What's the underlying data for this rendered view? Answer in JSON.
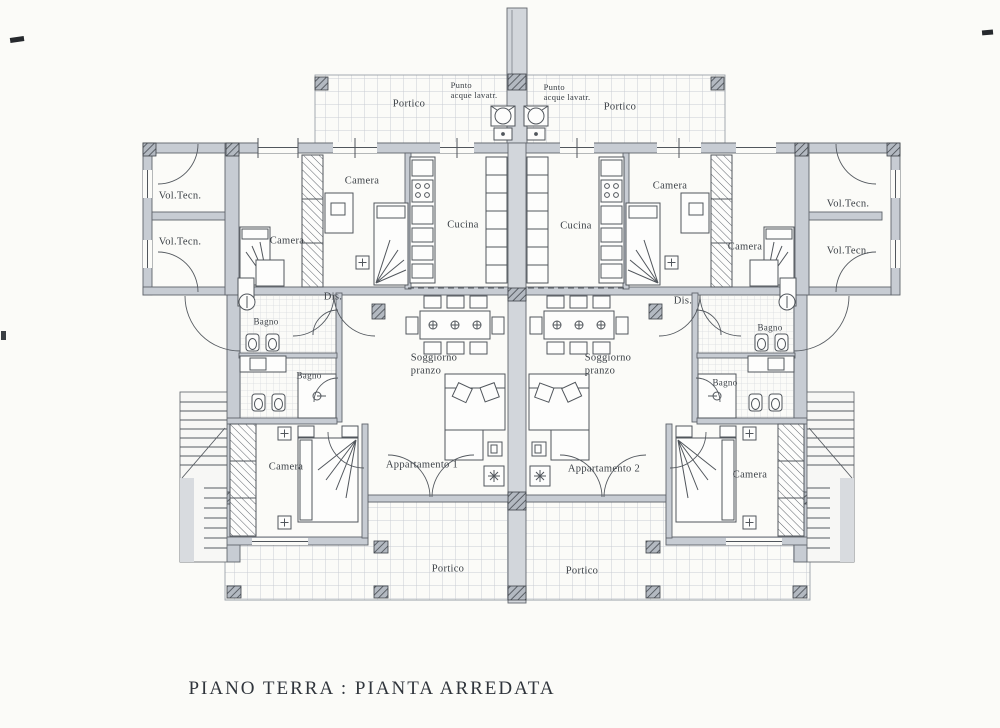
{
  "title": "PIANO TERRA : PIANTA ARREDATA",
  "colors": {
    "paper": "#fbfbf8",
    "wall_fill": "#c7ccd3",
    "line": "#51565c",
    "tile_line": "#c9cdd3",
    "text": "#3b4046"
  },
  "labels": {
    "portico_top_left": "Portico",
    "portico_top_right": "Portico",
    "portico_bottom_left": "Portico",
    "portico_bottom_right": "Portico",
    "punto_acque_left": "Punto\nacque lavatr.",
    "punto_acque_right": "Punto\nacque lavatr.",
    "vol_tecn_left_top": "Vol.Tecn.",
    "vol_tecn_left_bottom": "Vol.Tecn.",
    "vol_tecn_right_top": "Vol.Tecn.",
    "vol_tecn_right_bottom": "Vol.Tecn.",
    "camera_apt1_top": "Camera",
    "camera_apt1_mid": "Camera",
    "camera_apt1_bottom": "Camera",
    "camera_apt2_top": "Camera",
    "camera_apt2_mid": "Camera",
    "camera_apt2_bottom": "Camera",
    "cucina_apt1": "Cucina",
    "cucina_apt2": "Cucina",
    "dis_apt1": "Dis.",
    "dis_apt2": "Dis.",
    "bagno_apt1_upper": "Bagno",
    "bagno_apt1_lower": "Bagno",
    "bagno_apt2_upper": "Bagno",
    "bagno_apt2_lower": "Bagno",
    "soggiorno_apt1": "Soggiorno\npranzo",
    "soggiorno_apt2": "Soggiorno\npranzo",
    "apartment_1": "Appartamento 1",
    "apartment_2": "Appartamento 2"
  }
}
